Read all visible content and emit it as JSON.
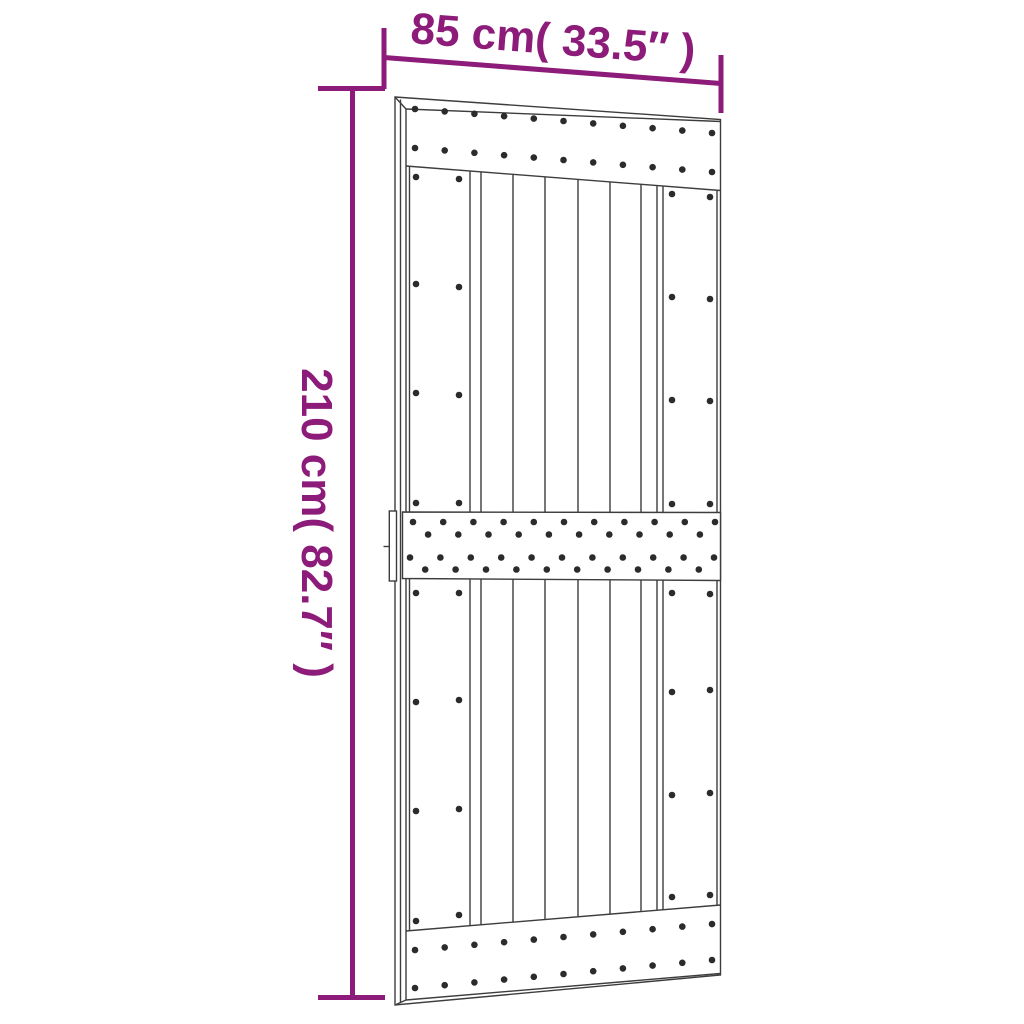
{
  "diagram": {
    "title": "door dimension diagram",
    "width_label": "85 cm( 33.5″ )",
    "height_label": "210 cm( 82.7″ )",
    "width": {
      "cm": "85",
      "inches": "33.5"
    },
    "height": {
      "cm": "210",
      "inches": "82.7"
    }
  },
  "colors": {
    "dimension": "#8c1b79",
    "outline": "#3d3d3d",
    "screw_dot": "#2b2b2b",
    "door_fill": "#ffffff",
    "background": "#ffffff"
  }
}
